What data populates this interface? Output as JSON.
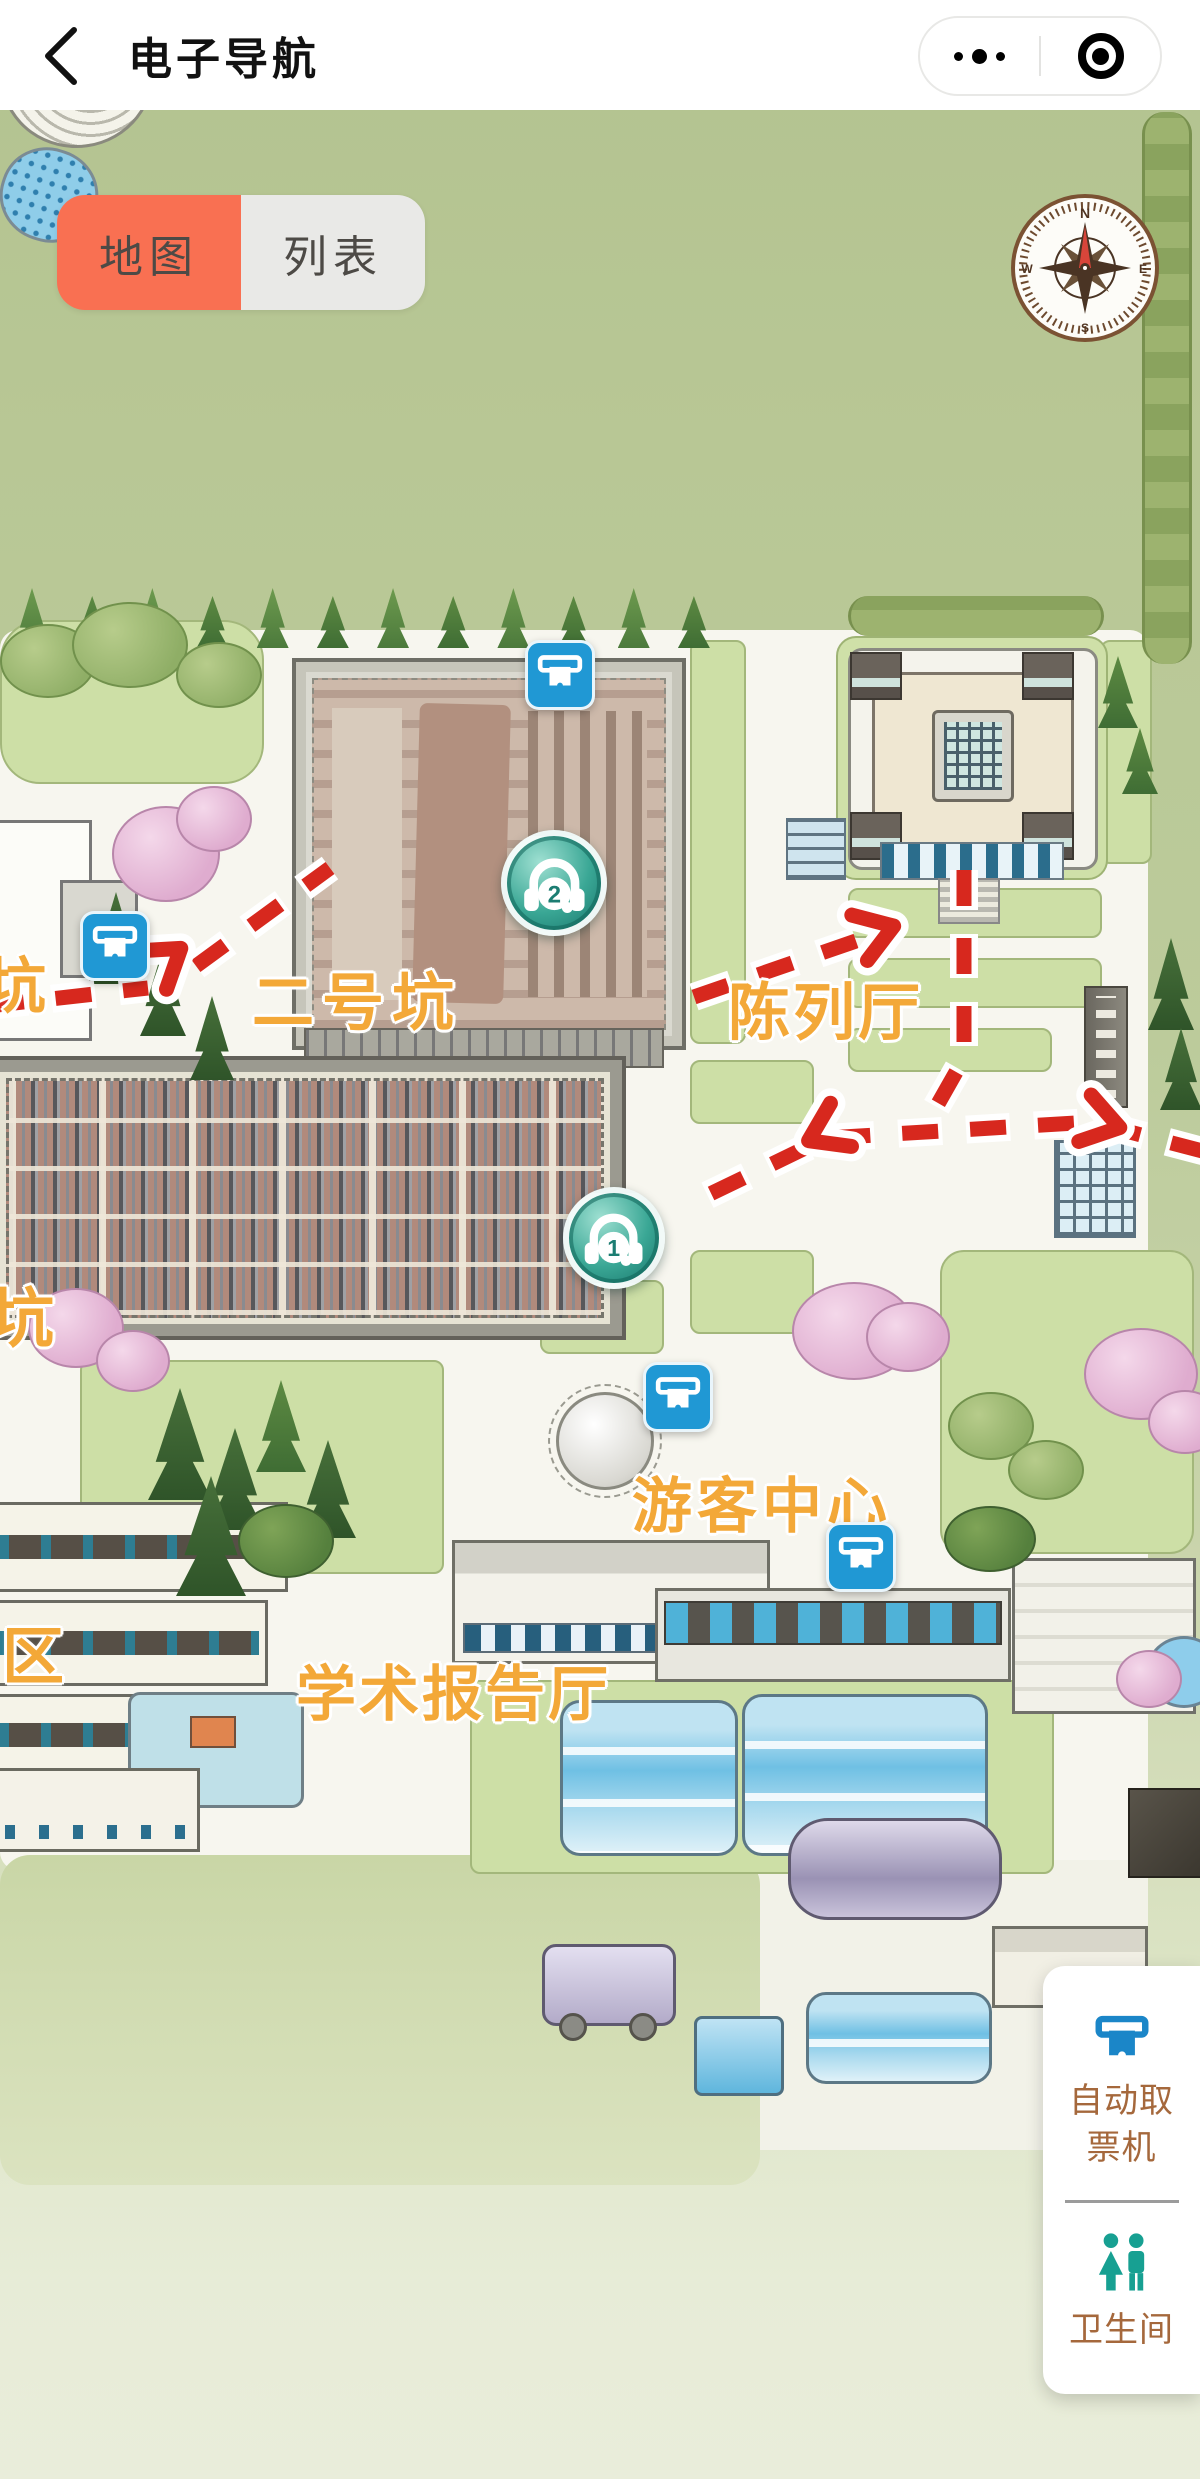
{
  "header": {
    "title": "电子导航"
  },
  "tabs": {
    "map": "地图",
    "list": "列表"
  },
  "compass": {
    "n": "N",
    "e": "E",
    "s": "S",
    "w": "W"
  },
  "map": {
    "labels": {
      "pit3_partial": "坑",
      "pit2": "二号坑",
      "exhibition_hall": "陈列厅",
      "pit1_partial": "坑",
      "visitor_center": "游客中心",
      "zone_partial": "区",
      "lecture_hall": "学术报告厅"
    },
    "markers": [
      {
        "number": "2",
        "type": "audio-guide-stop"
      },
      {
        "number": "1",
        "type": "audio-guide-stop"
      }
    ]
  },
  "legend": {
    "ticket_machine": "自动取票机",
    "restroom": "卫生间"
  },
  "colors": {
    "tab_active_orange": "#f97052",
    "map_label_orange": "#f3a838",
    "route_red": "#d7281e",
    "marker_teal": "#2d9a8c",
    "poi_blue": "#2098d4",
    "legend_text_brown": "#a5683c"
  }
}
